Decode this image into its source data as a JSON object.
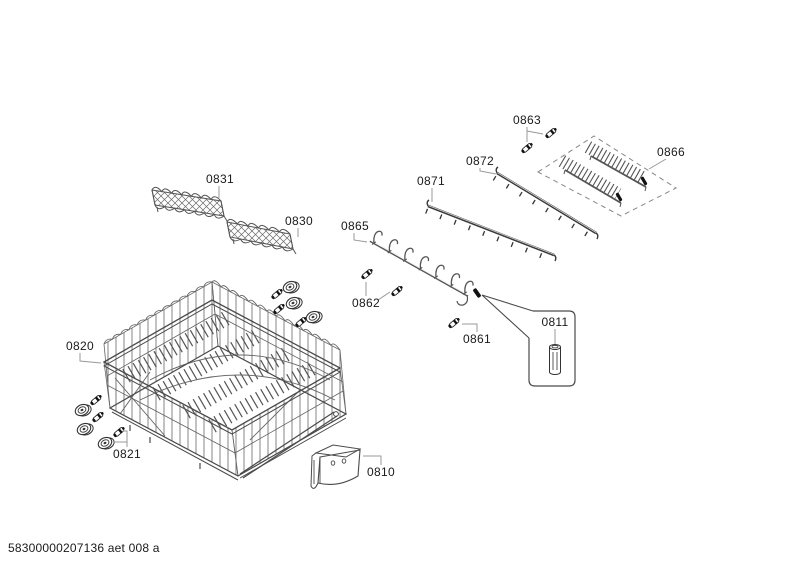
{
  "footer": {
    "doc_code": "58300000207136 aet 008 a"
  },
  "colors": {
    "part_line": "#4a4a4a",
    "leader_line": "#999999",
    "label_text": "#1a1a1a",
    "background": "#ffffff"
  },
  "parts": {
    "p0810": {
      "label": "0810"
    },
    "p0811": {
      "label": "0811"
    },
    "p0820": {
      "label": "0820"
    },
    "p0821": {
      "label": "0821"
    },
    "p0830": {
      "label": "0830"
    },
    "p0831": {
      "label": "0831"
    },
    "p0861": {
      "label": "0861"
    },
    "p0862": {
      "label": "0862"
    },
    "p0863": {
      "label": "0863"
    },
    "p0865": {
      "label": "0865"
    },
    "p0866": {
      "label": "0866"
    },
    "p0871": {
      "label": "0871"
    },
    "p0872": {
      "label": "0872"
    }
  }
}
